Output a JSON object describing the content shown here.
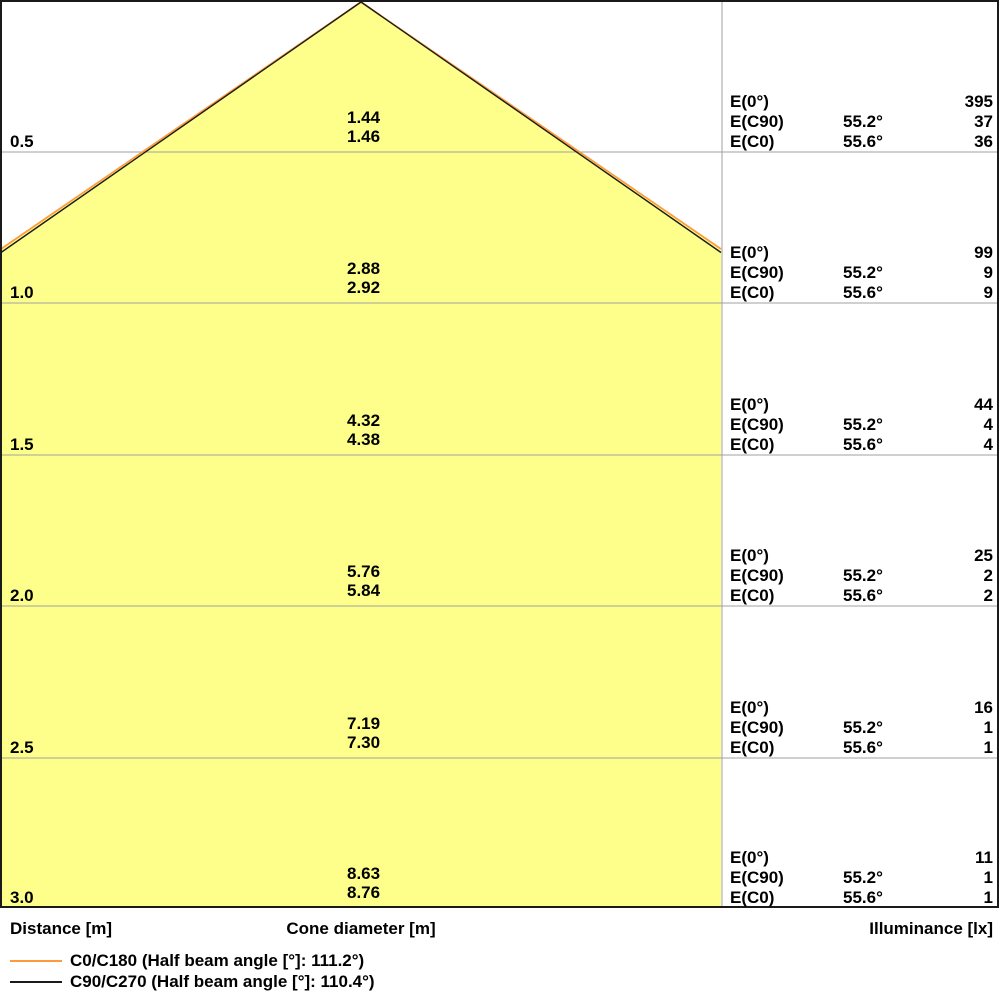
{
  "colors": {
    "cone_fill": "#FDFF8A",
    "c0_line": "#FF9A3C",
    "c90_line": "#1A1A1A",
    "gridline": "#A0A0A0",
    "border": "#1A1A1A",
    "background": "#FFFFFF"
  },
  "chart_data": {
    "type": "area",
    "axis_labels": {
      "left": "Distance [m]",
      "center": "Cone diameter [m]",
      "right": "Illuminance [lx]"
    },
    "legend": [
      {
        "series": "C0/C180",
        "label": "C0/C180 (Half beam angle [°]: 111.2°)",
        "color": "#FF9A3C"
      },
      {
        "series": "C90/C270",
        "label": "C90/C270 (Half beam angle [°]: 110.4°)",
        "color": "#1A1A1A"
      }
    ],
    "half_beam_angle_c0_c180_deg": 111.2,
    "half_beam_angle_c90_c270_deg": 110.4,
    "e_labels": {
      "e0": "E(0°)",
      "ec90": "E(C90)",
      "ec0": "E(C0)"
    },
    "rows": [
      {
        "distance": "0.5",
        "cone_diameter_c90": "1.44",
        "cone_diameter_c0": "1.46",
        "e0": "395",
        "ec90_angle": "55.2°",
        "ec90": "37",
        "ec0_angle": "55.6°",
        "ec0": "36"
      },
      {
        "distance": "1.0",
        "cone_diameter_c90": "2.88",
        "cone_diameter_c0": "2.92",
        "e0": "99",
        "ec90_angle": "55.2°",
        "ec90": "9",
        "ec0_angle": "55.6°",
        "ec0": "9"
      },
      {
        "distance": "1.5",
        "cone_diameter_c90": "4.32",
        "cone_diameter_c0": "4.38",
        "e0": "44",
        "ec90_angle": "55.2°",
        "ec90": "4",
        "ec0_angle": "55.6°",
        "ec0": "4"
      },
      {
        "distance": "2.0",
        "cone_diameter_c90": "5.76",
        "cone_diameter_c0": "5.84",
        "e0": "25",
        "ec90_angle": "55.2°",
        "ec90": "2",
        "ec0_angle": "55.6°",
        "ec0": "2"
      },
      {
        "distance": "2.5",
        "cone_diameter_c90": "7.19",
        "cone_diameter_c0": "7.30",
        "e0": "16",
        "ec90_angle": "55.2°",
        "ec90": "1",
        "ec0_angle": "55.6°",
        "ec0": "1"
      },
      {
        "distance": "3.0",
        "cone_diameter_c90": "8.63",
        "cone_diameter_c0": "8.76",
        "e0": "11",
        "ec90_angle": "55.2°",
        "ec90": "1",
        "ec0_angle": "55.6°",
        "ec0": "1"
      }
    ]
  }
}
